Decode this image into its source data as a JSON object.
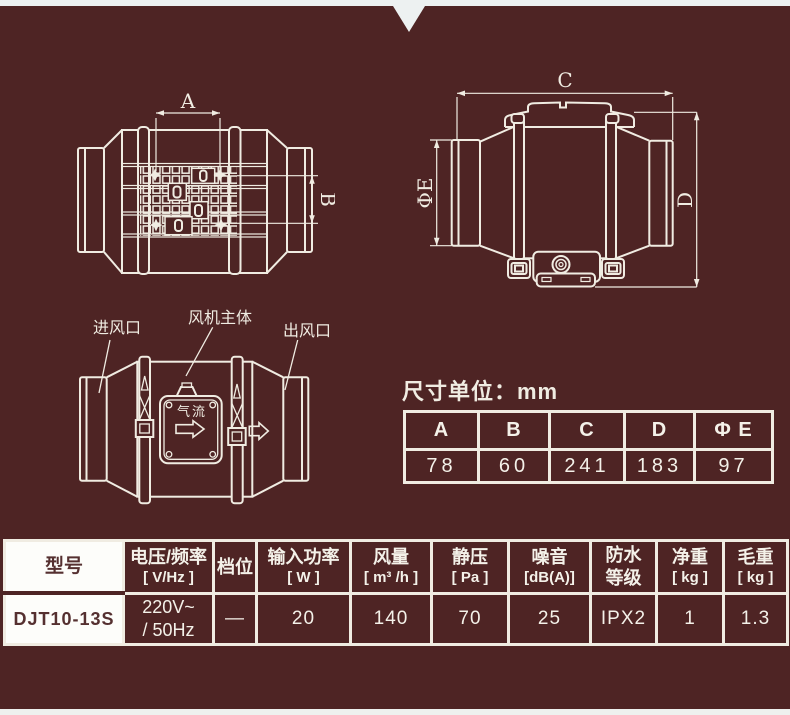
{
  "colors": {
    "background": "#4e2424",
    "line": "#f0ece2",
    "strip_top": "#edf1f1",
    "strip_bottom": "#eef0ee",
    "cell_white": "#fdfdfa",
    "dark_text": "#553030"
  },
  "diagrams": {
    "top_view": {
      "dim_a_label": "A",
      "dim_b_label": "B"
    },
    "side_view": {
      "dim_c_label": "C",
      "dim_d_label": "D",
      "dim_e_label": "ΦE"
    },
    "flow_view": {
      "inlet_label": "进风口",
      "body_label": "风机主体",
      "outlet_label": "出风口",
      "airflow_label": "气流"
    }
  },
  "dimensions": {
    "unit_note": "尺寸单位：mm",
    "headers": [
      "A",
      "B",
      "C",
      "D",
      "Φ E"
    ],
    "values": [
      "78",
      "60",
      "241",
      "183",
      "97"
    ]
  },
  "specs": {
    "headers": [
      {
        "line1": "型号",
        "line2": ""
      },
      {
        "line1": "电压/频率",
        "line2": "[ V/Hz ]"
      },
      {
        "line1": "档位",
        "line2": ""
      },
      {
        "line1": "输入功率",
        "line2": "[ W ]"
      },
      {
        "line1": "风量",
        "line2": "[ m³ /h ]"
      },
      {
        "line1": "静压",
        "line2": "[ Pa ]"
      },
      {
        "line1": "噪音",
        "line2": "[dB(A)]"
      },
      {
        "line1": "防水",
        "line2": "等级"
      },
      {
        "line1": "净重",
        "line2": "[ kg ]"
      },
      {
        "line1": "毛重",
        "line2": "[ kg ]"
      }
    ],
    "row": [
      {
        "line1": "DJT10-13S",
        "line2": ""
      },
      {
        "line1": "220V~",
        "line2": "/ 50Hz"
      },
      {
        "line1": "—",
        "line2": ""
      },
      {
        "line1": "20",
        "line2": ""
      },
      {
        "line1": "140",
        "line2": ""
      },
      {
        "line1": "70",
        "line2": ""
      },
      {
        "line1": "25",
        "line2": ""
      },
      {
        "line1": "IPX2",
        "line2": ""
      },
      {
        "line1": "1",
        "line2": ""
      },
      {
        "line1": "1.3",
        "line2": ""
      }
    ]
  }
}
